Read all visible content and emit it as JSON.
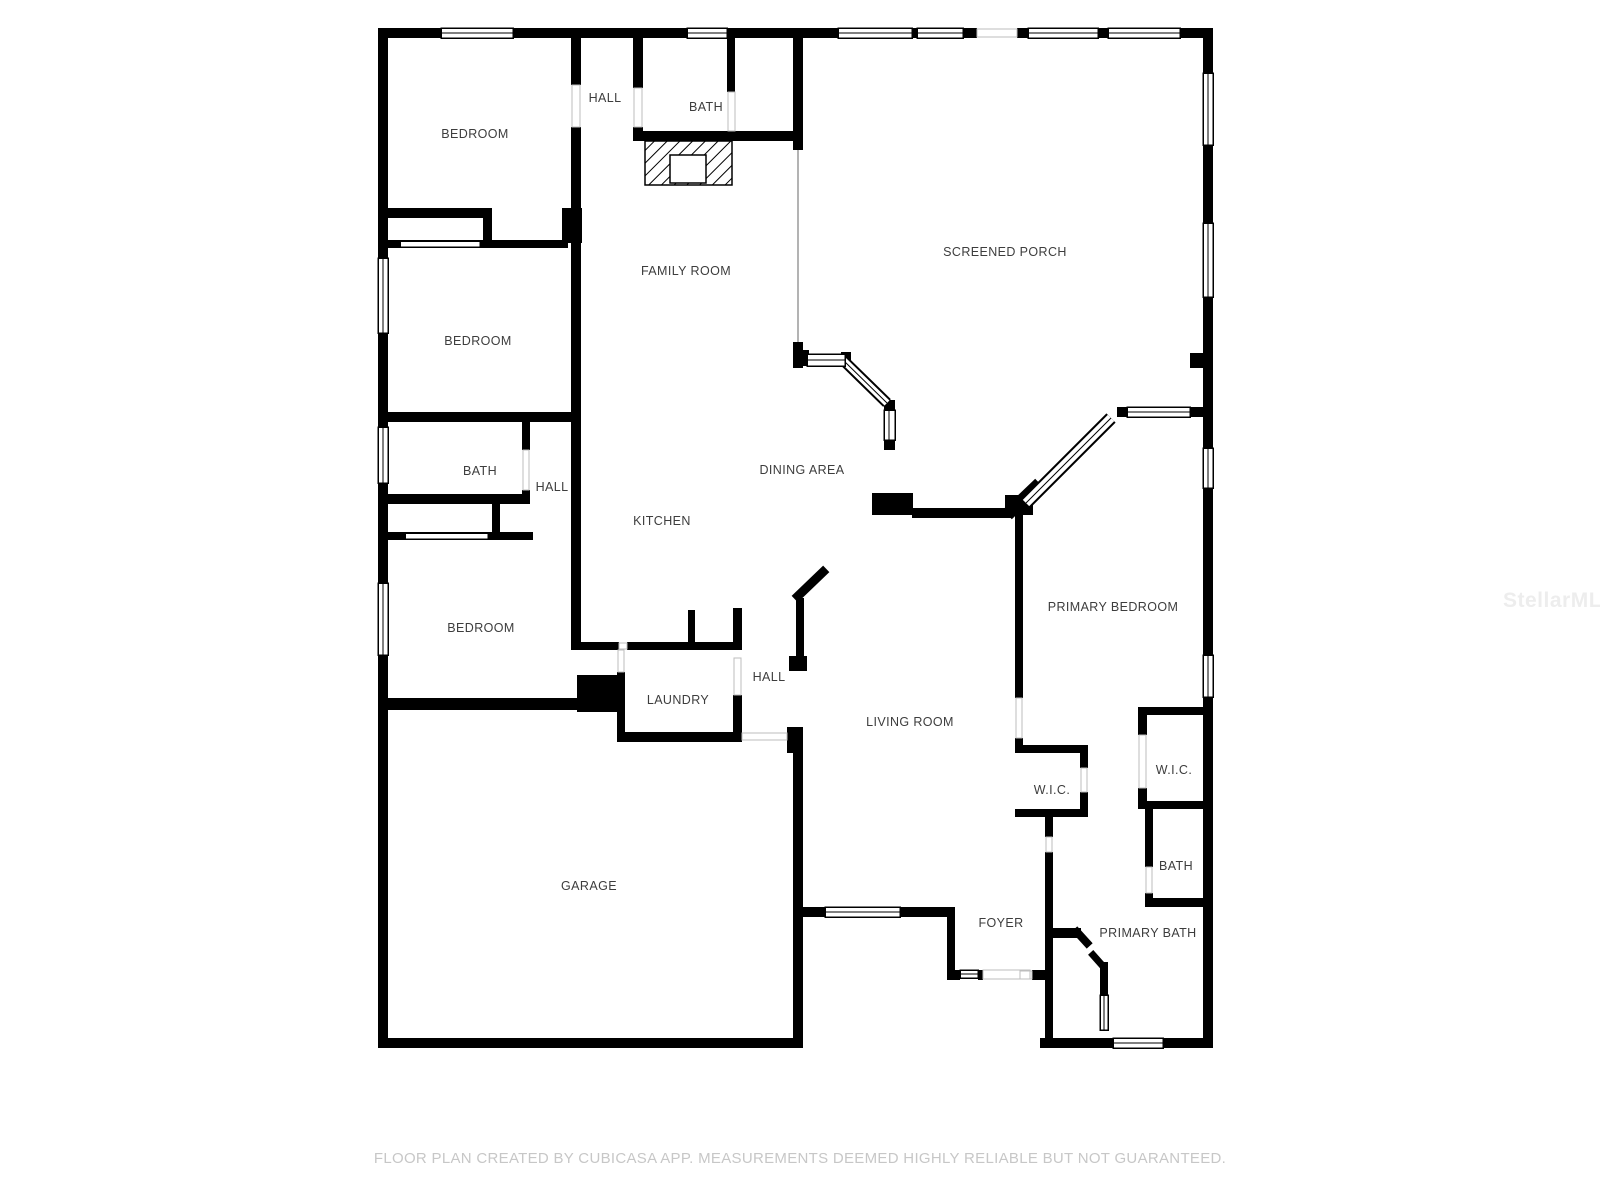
{
  "rooms": [
    {
      "id": "bedroom-1",
      "label": "BEDROOM"
    },
    {
      "id": "hall-1",
      "label": "HALL"
    },
    {
      "id": "bath-1",
      "label": "BATH"
    },
    {
      "id": "family-room",
      "label": "FAMILY ROOM"
    },
    {
      "id": "screened-porch",
      "label": "SCREENED PORCH"
    },
    {
      "id": "bedroom-2",
      "label": "BEDROOM"
    },
    {
      "id": "bath-2",
      "label": "BATH"
    },
    {
      "id": "hall-2",
      "label": "HALL"
    },
    {
      "id": "dining-area",
      "label": "DINING AREA"
    },
    {
      "id": "kitchen",
      "label": "KITCHEN"
    },
    {
      "id": "bedroom-3",
      "label": "BEDROOM"
    },
    {
      "id": "primary-bedroom",
      "label": "PRIMARY BEDROOM"
    },
    {
      "id": "laundry",
      "label": "LAUNDRY"
    },
    {
      "id": "hall-3",
      "label": "HALL"
    },
    {
      "id": "living-room",
      "label": "LIVING ROOM"
    },
    {
      "id": "wic-1",
      "label": "W.I.C."
    },
    {
      "id": "wic-2",
      "label": "W.I.C."
    },
    {
      "id": "garage",
      "label": "GARAGE"
    },
    {
      "id": "bath-3",
      "label": "BATH"
    },
    {
      "id": "foyer",
      "label": "FOYER"
    },
    {
      "id": "primary-bath",
      "label": "PRIMARY BATH"
    }
  ],
  "footer": {
    "text": "FLOOR PLAN CREATED BY CUBICASA APP. MEASUREMENTS DEEMED HIGHLY RELIABLE BUT NOT GUARANTEED."
  },
  "watermark": {
    "text": "StellarMLS"
  },
  "colors": {
    "wall": "#000000",
    "label": "#3d3d3d",
    "footer": "#c7c7c7",
    "watermark": "#ededed",
    "background": "#ffffff"
  }
}
